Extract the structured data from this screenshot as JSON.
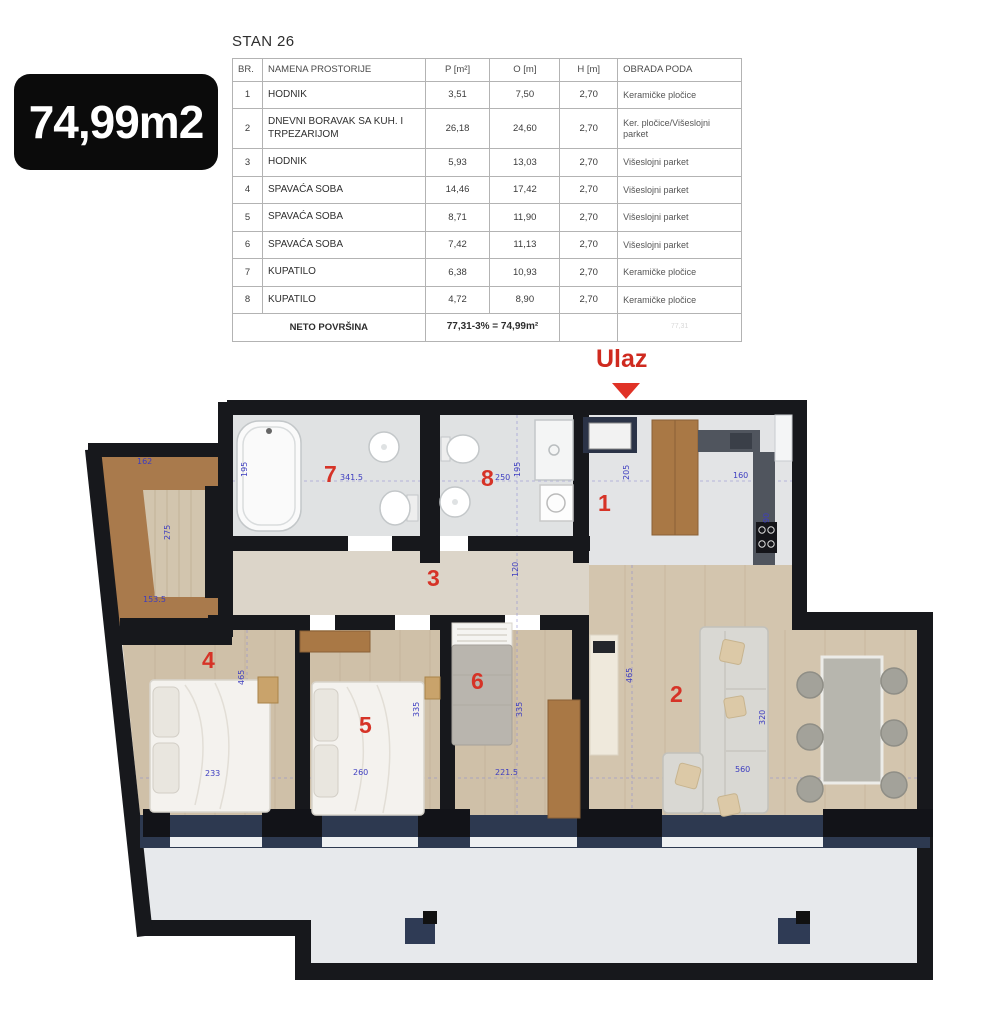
{
  "badge": {
    "area_label": "74,99m2"
  },
  "title": "STAN 26",
  "table": {
    "headers": [
      "BR.",
      "NAMENA PROSTORIJE",
      "P [m²]",
      "O [m]",
      "H [m]",
      "OBRADA PODA"
    ],
    "rows": [
      [
        "1",
        "HODNIK",
        "3,51",
        "7,50",
        "2,70",
        "Keramičke pločice"
      ],
      [
        "2",
        "DNEVNI BORAVAK SA KUH. I TRPEZARIJOM",
        "26,18",
        "24,60",
        "2,70",
        "Ker. pločice/Višeslojni parket"
      ],
      [
        "3",
        "HODNIK",
        "5,93",
        "13,03",
        "2,70",
        "Višeslojni parket"
      ],
      [
        "4",
        "SPAVAĆA SOBA",
        "14,46",
        "17,42",
        "2,70",
        "Višeslojni parket"
      ],
      [
        "5",
        "SPAVAĆA SOBA",
        "8,71",
        "11,90",
        "2,70",
        "Višeslojni parket"
      ],
      [
        "6",
        "SPAVAĆA SOBA",
        "7,42",
        "11,13",
        "2,70",
        "Višeslojni parket"
      ],
      [
        "7",
        "KUPATILO",
        "6,38",
        "10,93",
        "2,70",
        "Keramičke pločice"
      ],
      [
        "8",
        "KUPATILO",
        "4,72",
        "8,90",
        "2,70",
        "Keramičke pločice"
      ]
    ],
    "footer": {
      "label": "NETO POVRŠINA",
      "formula": "77,31-3% = 74,99m²",
      "ghost": "77,31"
    }
  },
  "plan": {
    "entrance_label": "Ulaz",
    "room_numbers": [
      {
        "n": "7",
        "x": 239,
        "y": 116
      },
      {
        "n": "8",
        "x": 396,
        "y": 120
      },
      {
        "n": "1",
        "x": 513,
        "y": 145
      },
      {
        "n": "3",
        "x": 342,
        "y": 220
      },
      {
        "n": "4",
        "x": 117,
        "y": 302
      },
      {
        "n": "5",
        "x": 274,
        "y": 367
      },
      {
        "n": "6",
        "x": 386,
        "y": 323
      },
      {
        "n": "2",
        "x": 585,
        "y": 336
      }
    ],
    "dimensions": [
      {
        "t": "162",
        "x": 52,
        "y": 112,
        "v": 0
      },
      {
        "t": "275",
        "x": 78,
        "y": 195,
        "v": 1
      },
      {
        "t": "153.5",
        "x": 58,
        "y": 250,
        "v": 0
      },
      {
        "t": "341.5",
        "x": 255,
        "y": 128,
        "v": 0
      },
      {
        "t": "195",
        "x": 155,
        "y": 132,
        "v": 1
      },
      {
        "t": "250",
        "x": 410,
        "y": 128,
        "v": 0
      },
      {
        "t": "195",
        "x": 428,
        "y": 132,
        "v": 1
      },
      {
        "t": "205",
        "x": 537,
        "y": 135,
        "v": 1
      },
      {
        "t": "160",
        "x": 648,
        "y": 126,
        "v": 0
      },
      {
        "t": "90",
        "x": 677,
        "y": 178,
        "v": 1
      },
      {
        "t": "120",
        "x": 426,
        "y": 232,
        "v": 1
      },
      {
        "t": "465",
        "x": 152,
        "y": 340,
        "v": 1
      },
      {
        "t": "233",
        "x": 120,
        "y": 424,
        "v": 0
      },
      {
        "t": "335",
        "x": 327,
        "y": 372,
        "v": 1
      },
      {
        "t": "260",
        "x": 268,
        "y": 423,
        "v": 0
      },
      {
        "t": "221.5",
        "x": 410,
        "y": 423,
        "v": 0
      },
      {
        "t": "335",
        "x": 430,
        "y": 372,
        "v": 1
      },
      {
        "t": "465",
        "x": 540,
        "y": 338,
        "v": 1
      },
      {
        "t": "320",
        "x": 673,
        "y": 380,
        "v": 1
      },
      {
        "t": "560",
        "x": 650,
        "y": 420,
        "v": 0
      }
    ],
    "colors": {
      "wall": "#17181c",
      "room_number_red": "#d63327",
      "dimension_blue": "#3d3dc0",
      "entrance_red": "#cf2a1f",
      "wood_floor": "#cfc0a8",
      "tile_floor": "#e0e2e3",
      "terrace_floor": "#e7e9ec",
      "furniture_brown": "#a97845",
      "window_navy": "#2d3950"
    }
  }
}
